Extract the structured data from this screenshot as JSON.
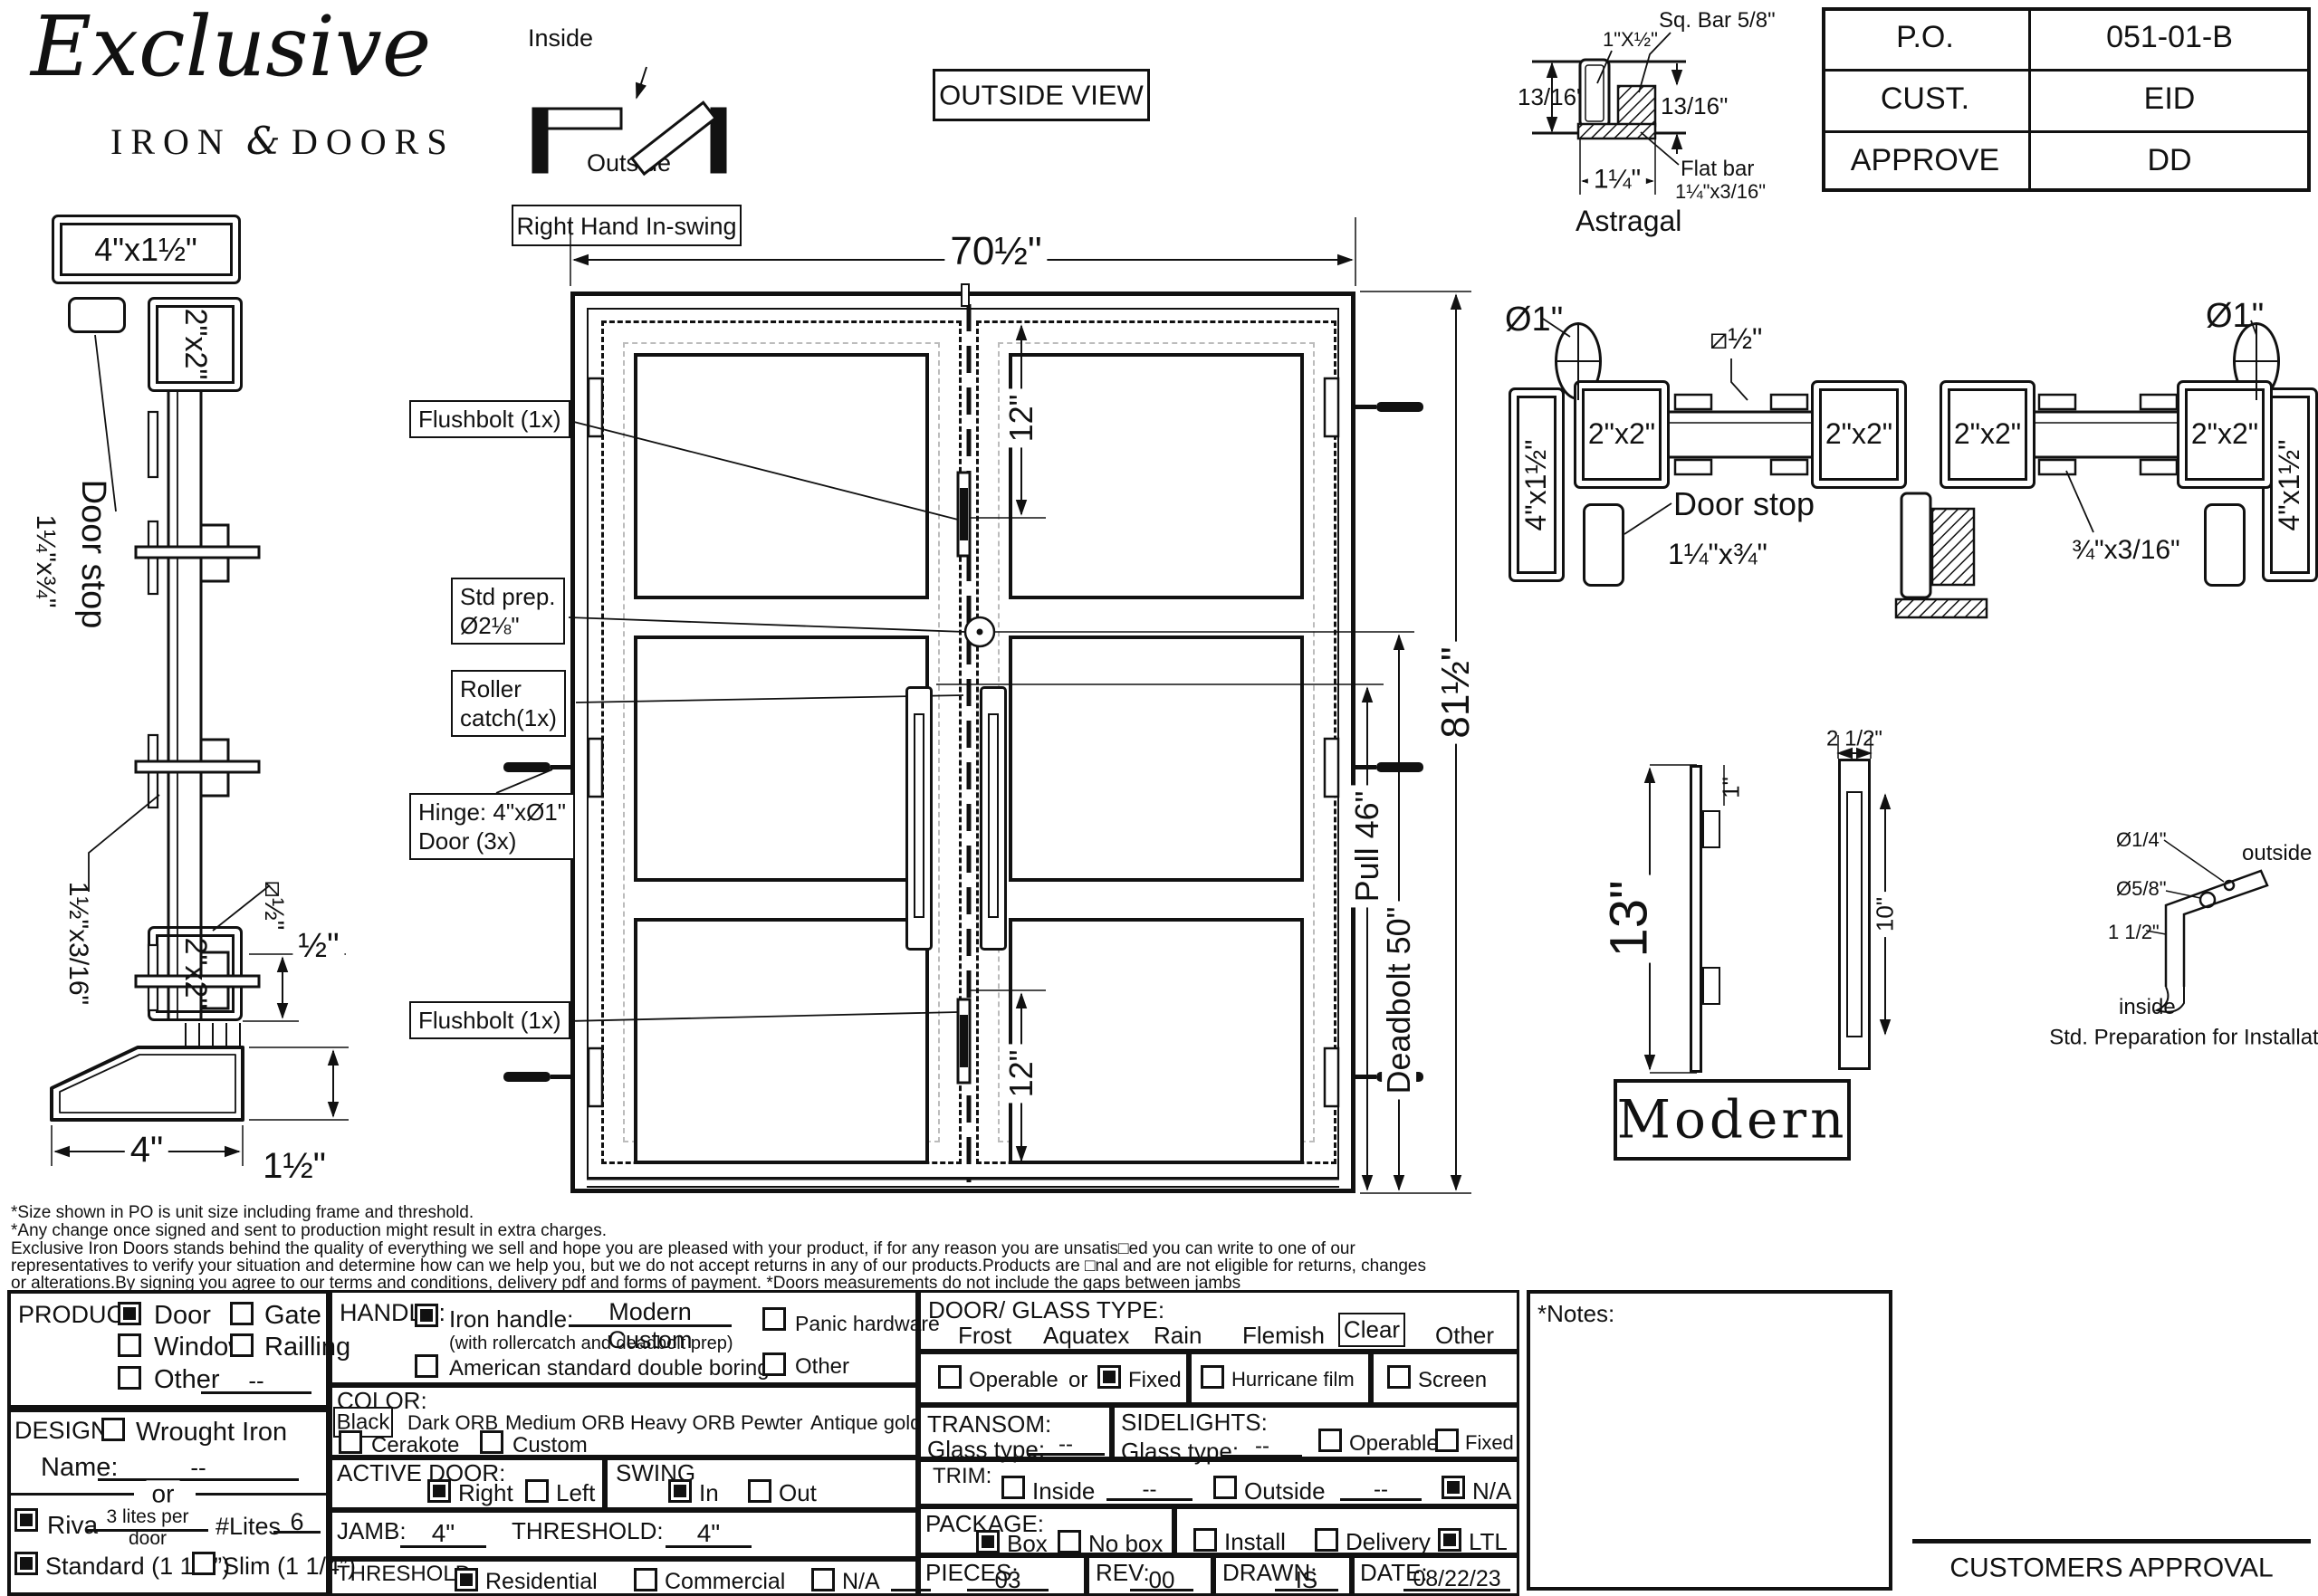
{
  "logo": {
    "script": "Exclusive",
    "iron": "IRON",
    "amp": "&",
    "doors": "DOORS"
  },
  "swing_diagram": {
    "inside": "Inside",
    "outside": "Outside",
    "handing": "Right Hand In-swing"
  },
  "view_label": "OUTSIDE VIEW",
  "title_block": {
    "rows": [
      {
        "label": "P.O.",
        "value": "051-01-B"
      },
      {
        "label": "CUST.",
        "value": "EID"
      },
      {
        "label": "APPROVE",
        "value": "DD"
      }
    ]
  },
  "astragal": {
    "sq_bar": "Sq. Bar 5/8\"",
    "tube": "1\"X½\"",
    "dim_left": "13/16\"",
    "dim_right": "13/16\"",
    "flat_bar_l1": "Flat bar",
    "flat_bar_l2": "1¼\"x3/16\"",
    "width": "1¼\"",
    "caption": "Astragal"
  },
  "jamb_section": {
    "head": "4\"x1½\"",
    "tube": "2\"x2\"",
    "door_stop_l1": "Door stop",
    "door_stop_l2": "1¼\"x¾\"",
    "flat": "1½\"x3/16\"",
    "square": "⧄½\"",
    "bottom_tube": "2\"x2\"",
    "lip": "½\"",
    "width": "4\"",
    "height": "1½\""
  },
  "elevation": {
    "width": "70½\"",
    "height": "81½\"",
    "pull": "Pull 46\"",
    "deadbolt": "Deadbolt 50\"",
    "lite_top": "12\"",
    "lite_bottom": "12\"",
    "flushbolt_top": "Flushbolt (1x)",
    "std_prep_l1": "Std prep.",
    "std_prep_l2": "Ø2⅛\"",
    "roller_l1": "Roller",
    "roller_l2": "catch(1x)",
    "hinge_l1": "Hinge: 4\"xØ1\"",
    "hinge_l2": "Door (3x)",
    "flushbolt_bottom": "Flushbolt (1x)"
  },
  "plan_section": {
    "dia_left": "Ø1\"",
    "dia_right": "Ø1\"",
    "jamb_left": "4\"x1½\"",
    "jamb_right": "4\"x1½\"",
    "stile_1": "2\"x2\"",
    "stile_2": "2\"x2\"",
    "stile_3": "2\"x2\"",
    "stile_4": "2\"x2\"",
    "square": "⧄½\"",
    "door_stop_l1": "Door stop",
    "door_stop_l2": "1¼\"x¾\"",
    "flat": "¾\"x3/16\""
  },
  "handle_detail": {
    "height": "13\"",
    "top": "1\"",
    "width": "2 1/2\"",
    "slot": "10\""
  },
  "prep_detail": {
    "hole_small": "Ø1/4\"",
    "outside": "outside",
    "hole_large": "Ø5/8\"",
    "offset": "1 1/2\"",
    "inside": "inside",
    "caption": "Std. Preparation for Installation"
  },
  "style_label": "Modern",
  "disclaimer": {
    "l1": "*Size shown in PO is unit size including frame and threshold.",
    "l2": "*Any change once signed and sent to production might result in extra charges.",
    "l3": "Exclusive Iron Doors stands behind the quality of everything we sell and hope you are pleased with your product, if for any reason you are unsatis□ed you can write to one of our",
    "l4": "representatives to verify your situation and determine how can we help you, but we do not accept returns in any of our products.Products are □nal and are not eligible for returns, changes",
    "l5": "or alterations.By signing you agree to our terms and conditions, delivery pdf and forms of payment. *Doors measurements do not include the gaps between jambs"
  },
  "form": {
    "product": {
      "title": "PRODUCT:",
      "door": "Door",
      "door_checked": true,
      "gate": "Gate",
      "gate_checked": false,
      "window": "Window",
      "window_checked": false,
      "railing": "Railling",
      "railing_checked": false,
      "other": "Other",
      "other_checked": false,
      "other_value": "--"
    },
    "design": {
      "title": "DESIGN:",
      "wrought": "Wrought Iron",
      "wrought_checked": false,
      "name_label": "Name:",
      "name_value": "--",
      "or": "or",
      "riva": "Riva",
      "riva_checked": true,
      "riva_value": "3 lites per door",
      "lites_label": "#Lites",
      "lites_value": "6",
      "standard": "Standard (1 1/2”)",
      "standard_checked": true,
      "slim": "Slim (1 1/4”)",
      "slim_checked": false
    },
    "handle": {
      "title": "HANDLE:",
      "iron": "Iron handle:",
      "iron_checked": true,
      "iron_value": "Modern Custom",
      "iron_note": "(with rollercatch and deadbolt prep)",
      "american": "American standard double boring",
      "american_checked": false,
      "panic": "Panic hardware",
      "panic_checked": false,
      "other": "Other",
      "other_checked": false
    },
    "color": {
      "title": "COLOR:",
      "selected": "Black",
      "opt1": "Dark ORB",
      "opt2": "Medium ORB",
      "opt3": "Heavy ORB",
      "opt4": "Pewter",
      "opt5": "Antique gold",
      "cerakote": "Cerakote",
      "cerakote_checked": false,
      "custom": "Custom",
      "custom_checked": false
    },
    "active_door": {
      "title": "ACTIVE DOOR:",
      "right": "Right",
      "right_checked": true,
      "left": "Left",
      "left_checked": false
    },
    "swing": {
      "title": "SWING",
      "in": "In",
      "in_checked": true,
      "out": "Out",
      "out_checked": false
    },
    "jamb": {
      "title": "JAMB:",
      "value": "4\"",
      "threshold_title": "THRESHOLD:",
      "threshold_value": "4\""
    },
    "threshold": {
      "title": "THRESHOLD:",
      "residential": "Residential",
      "residential_checked": true,
      "commercial": "Commercial",
      "commercial_checked": false,
      "na": "N/A",
      "na_checked": false
    },
    "glass": {
      "title": "DOOR/ GLASS TYPE:",
      "opt1": "Frost",
      "opt2": "Aquatex",
      "opt3": "Rain",
      "opt4": "Flemish",
      "selected": "Clear",
      "opt5": "Other",
      "operable": "Operable",
      "operable_checked": false,
      "or": "or",
      "fixed": "Fixed",
      "fixed_checked": true,
      "hurricane": "Hurricane film",
      "hurricane_checked": false,
      "screen": "Screen",
      "screen_checked": false
    },
    "transom": {
      "title": "TRANSOM:",
      "glass_label": "Glass type:",
      "glass_value": "--"
    },
    "sidelights": {
      "title": "SIDELIGHTS:",
      "glass_label": "Glass type:",
      "glass_value": "--",
      "operable": "Operable",
      "operable_checked": false,
      "fixed": "Fixed",
      "fixed_checked": false
    },
    "trim": {
      "title": "TRIM:",
      "inside": "Inside",
      "inside_checked": false,
      "inside_value": "--",
      "outside": "Outside",
      "outside_checked": false,
      "outside_value": "--",
      "na": "N/A",
      "na_checked": true
    },
    "package": {
      "title": "PACKAGE:",
      "box": "Box",
      "box_checked": true,
      "no_box": "No box",
      "no_box_checked": false,
      "install": "Install",
      "install_checked": false,
      "delivery": "Delivery",
      "delivery_checked": false,
      "ltl": "LTL",
      "ltl_checked": true
    },
    "meta": {
      "pieces_label": "PIECES:",
      "pieces": "03",
      "rev_label": "REV:",
      "rev": "00",
      "drawn_label": "DRAWN:",
      "drawn": "IS",
      "date_label": "DATE:",
      "date": "08/22/23"
    }
  },
  "approval": {
    "notes": "*Notes:",
    "signature": "CUSTOMERS APPROVAL"
  }
}
